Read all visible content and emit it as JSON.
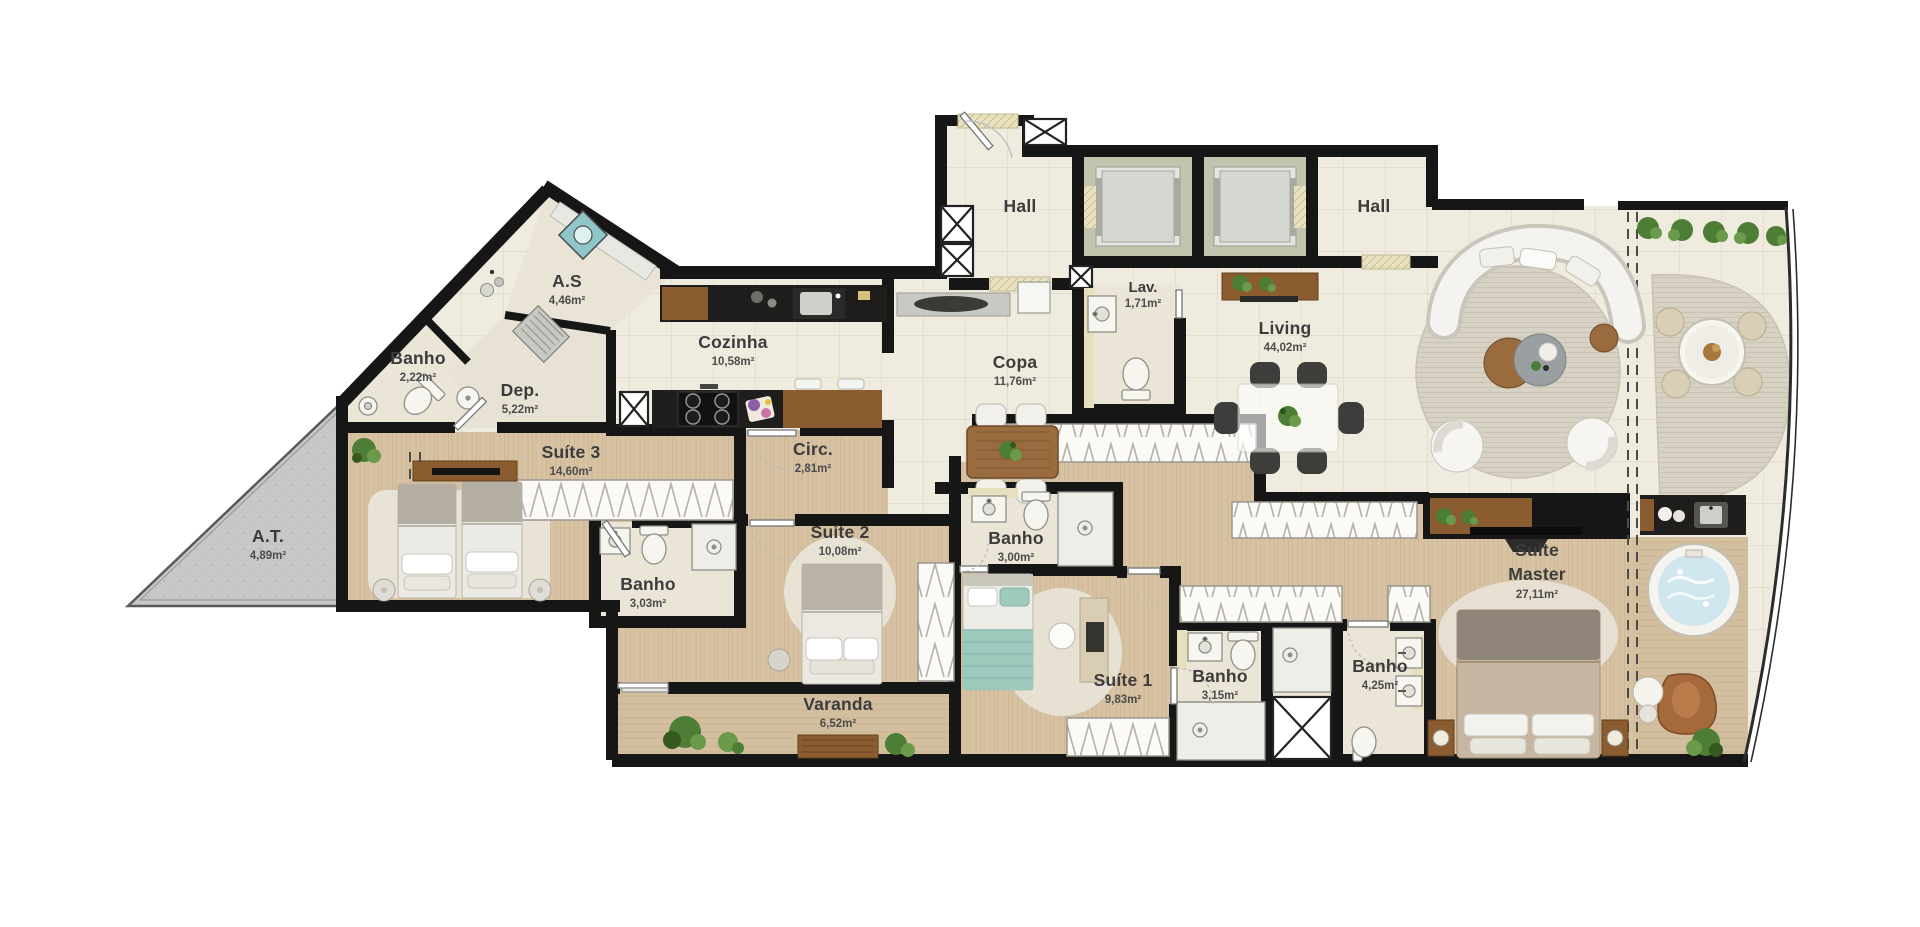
{
  "plan_title": "Apartment floor plan",
  "rooms": [
    {
      "id": "at",
      "name": "A.T.",
      "area": "4,89m²"
    },
    {
      "id": "banho-social",
      "name": "Banho",
      "area": "2,22m²"
    },
    {
      "id": "dep",
      "name": "Dep.",
      "area": "5,22m²"
    },
    {
      "id": "as",
      "name": "A.S",
      "area": "4,46m²"
    },
    {
      "id": "cozinha",
      "name": "Cozinha",
      "area": "10,58m²"
    },
    {
      "id": "copa",
      "name": "Copa",
      "area": "11,76m²"
    },
    {
      "id": "hall-left",
      "name": "Hall"
    },
    {
      "id": "hall-right",
      "name": "Hall"
    },
    {
      "id": "lav",
      "name": "Lav.",
      "area": "1,71m²"
    },
    {
      "id": "living",
      "name": "Living",
      "area": "44,02m²"
    },
    {
      "id": "suite-3",
      "name": "Suíte 3",
      "area": "14,60m²"
    },
    {
      "id": "banho-suite-3",
      "name": "Banho",
      "area": "3,03m²"
    },
    {
      "id": "circ",
      "name": "Circ.",
      "area": "2,81m²"
    },
    {
      "id": "suite-2",
      "name": "Suíte 2",
      "area": "10,08m²"
    },
    {
      "id": "banho-suite-2",
      "name": "Banho",
      "area": "3,00m²"
    },
    {
      "id": "varanda",
      "name": "Varanda",
      "area": "6,52m²"
    },
    {
      "id": "suite-1",
      "name": "Suíte 1",
      "area": "9,83m²"
    },
    {
      "id": "banho-suite-1",
      "name": "Banho",
      "area": "3,15m²"
    },
    {
      "id": "banho-master",
      "name": "Banho",
      "area": "4,25m²"
    },
    {
      "id": "suite-master",
      "line1": "Suíte",
      "line2": "Master",
      "area": "27,11m²"
    }
  ],
  "colors": {
    "wall": "#161616",
    "floor_social": "#efecdf",
    "floor_grid_line": "#dfd9c8",
    "floor_wood": "#d7c3a4",
    "floor_bath": "#eae5d7",
    "floor_technical_gray": "#c7c7c7",
    "rug": "#d8d2c5",
    "counter_dark": "#1f1e1c",
    "cabinet_wood": "#8a5c30",
    "bed_teal": "#9ec9bd",
    "jacuzzi_water": "#cfe6ee",
    "plant_green": "#4e7d35",
    "door_mat": "#e9e2c0",
    "elevator_frame": "#c2c4ae"
  }
}
